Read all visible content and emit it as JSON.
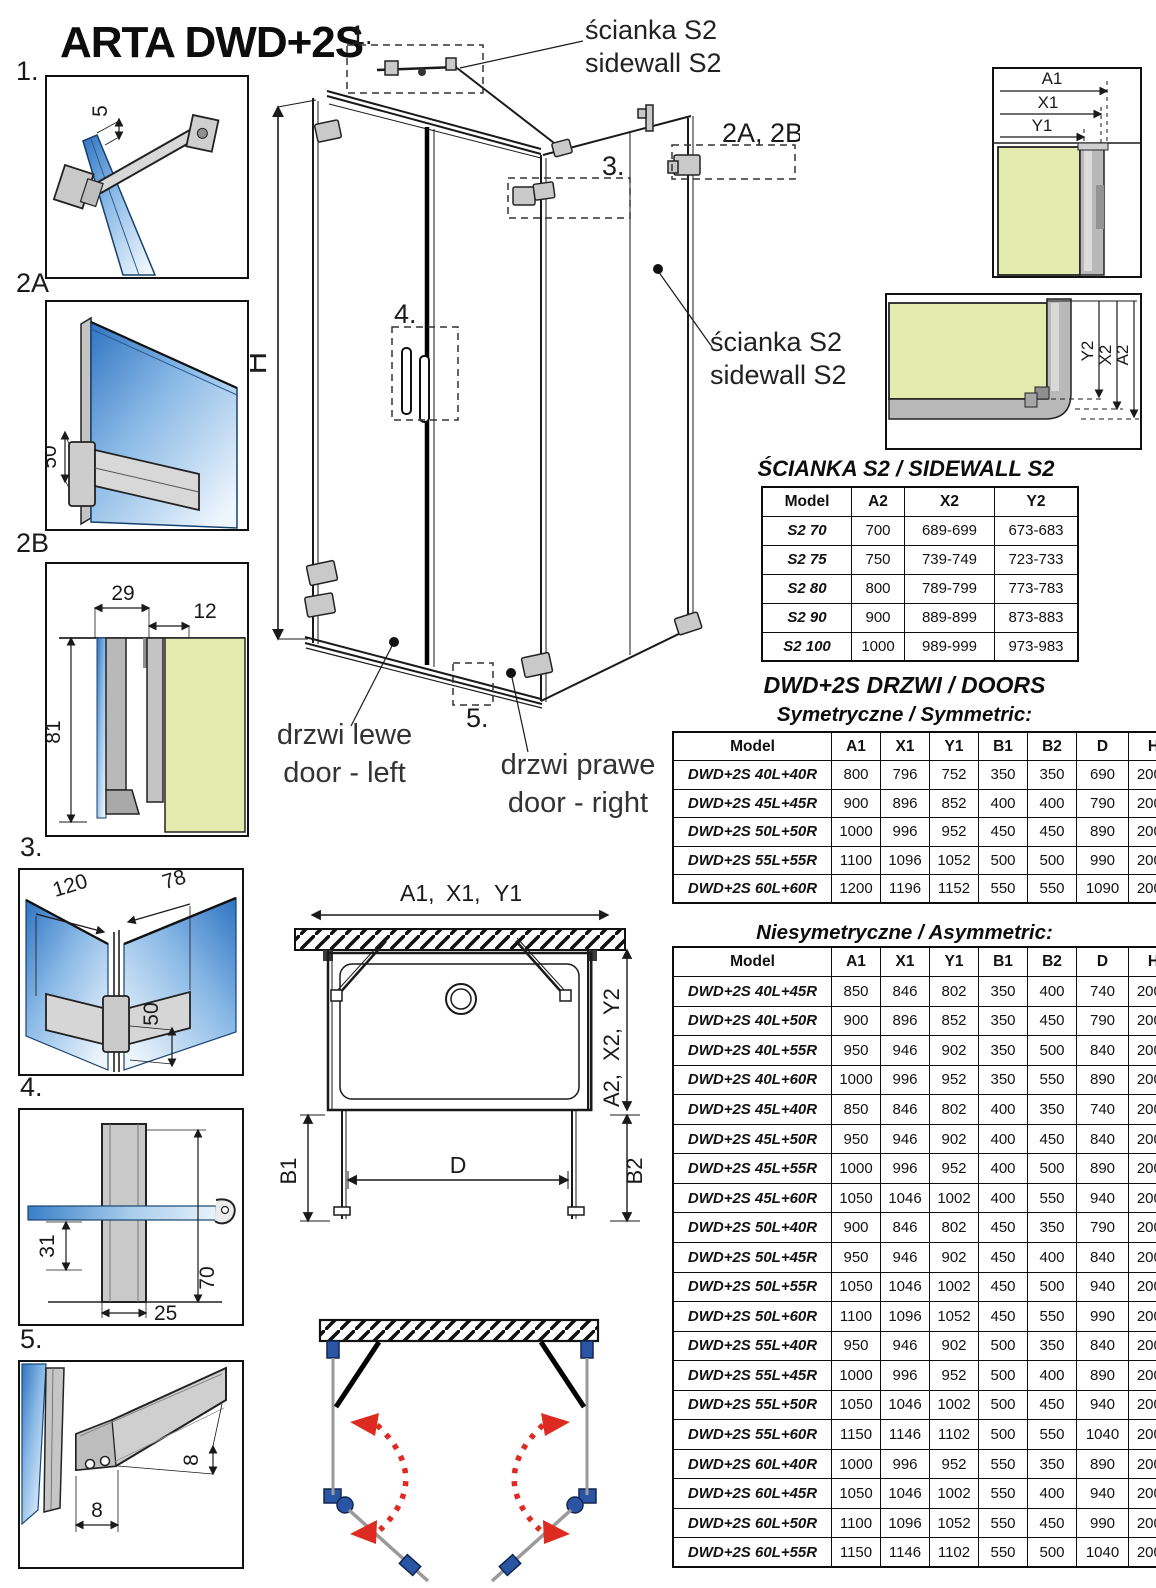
{
  "title": "ARTA DWD+2S",
  "colors": {
    "dim_red": "#cf2726",
    "dim_gray": "#8a8a8a",
    "dim_blue": "#2c4d92",
    "dim_purple": "#5d4a9c",
    "glass_blue": "#2f74c2",
    "glass_green": "#e3ebae",
    "arrow_red": "#dd2b22",
    "hardware_blue": "#2a55a4"
  },
  "details": {
    "d1": {
      "label": "1.",
      "dim_gap": "5"
    },
    "d2a": {
      "label": "2A",
      "dim_height": "50"
    },
    "d2b": {
      "label": "2B",
      "dim_a": "29",
      "dim_b": "12",
      "dim_c": "81"
    },
    "d3": {
      "label": "3.",
      "dim_a": "120",
      "dim_b": "78",
      "dim_c": "50"
    },
    "d4": {
      "label": "4.",
      "dim_a": "31",
      "dim_b": "25",
      "dim_c": "70"
    },
    "d5": {
      "label": "5.",
      "dim_a": "8",
      "dim_b": "8"
    }
  },
  "main": {
    "callout_1": "1.",
    "callout_2ab": "2A, 2B",
    "callout_3": "3.",
    "callout_4": "4.",
    "callout_5": "5.",
    "height_label": "H",
    "sidewall_top": {
      "pl": "ścianka S2",
      "en": "sidewall S2"
    },
    "sidewall_right": {
      "pl": "ścianka S2",
      "en": "sidewall S2"
    },
    "door_left": {
      "pl": "drzwi lewe",
      "en": "door - left"
    },
    "door_right": {
      "pl": "drzwi prawe",
      "en": "door - right"
    }
  },
  "corner_top": {
    "a1": "A1",
    "x1": "X1",
    "y1": "Y1"
  },
  "corner_bottom": {
    "a2": "A2",
    "x2": "X2",
    "y2": "Y2"
  },
  "plan": {
    "a1": "A1,",
    "x1": "X1,",
    "y1": "Y1",
    "a2": "A2,",
    "x2": "X2,",
    "y2": "Y2",
    "b1": "B1",
    "b2": "B2",
    "d": "D"
  },
  "sidewall_table": {
    "title": "ŚCIANKA S2 / SIDEWALL S2",
    "headers": [
      "Model",
      "A2",
      "X2",
      "Y2"
    ],
    "header_styles": [
      "",
      "",
      "red",
      "gray"
    ],
    "rows": [
      [
        "S2 70",
        "700",
        "689-699",
        "673-683"
      ],
      [
        "S2 75",
        "750",
        "739-749",
        "723-733"
      ],
      [
        "S2 80",
        "800",
        "789-799",
        "773-783"
      ],
      [
        "S2 90",
        "900",
        "889-899",
        "873-883"
      ],
      [
        "S2 100",
        "1000",
        "989-999",
        "973-983"
      ]
    ]
  },
  "doors": {
    "title": "DWD+2S DRZWI / DOORS",
    "symmetric": {
      "title": "Symetryczne / Symmetric:",
      "headers": [
        "Model",
        "A1",
        "X1",
        "Y1",
        "B1",
        "B2",
        "D",
        "H"
      ],
      "header_styles": [
        "",
        "",
        "red",
        "gray",
        "blue",
        "blue",
        "purple",
        ""
      ],
      "rows": [
        [
          "DWD+2S 40L+40R",
          "800",
          "796",
          "752",
          "350",
          "350",
          "690",
          "2000"
        ],
        [
          "DWD+2S 45L+45R",
          "900",
          "896",
          "852",
          "400",
          "400",
          "790",
          "2000"
        ],
        [
          "DWD+2S 50L+50R",
          "1000",
          "996",
          "952",
          "450",
          "450",
          "890",
          "2000"
        ],
        [
          "DWD+2S 55L+55R",
          "1100",
          "1096",
          "1052",
          "500",
          "500",
          "990",
          "2000"
        ],
        [
          "DWD+2S 60L+60R",
          "1200",
          "1196",
          "1152",
          "550",
          "550",
          "1090",
          "2000"
        ]
      ]
    },
    "asymmetric": {
      "title": "Niesymetryczne / Asymmetric:",
      "headers": [
        "Model",
        "A1",
        "X1",
        "Y1",
        "B1",
        "B2",
        "D",
        "H"
      ],
      "header_styles": [
        "",
        "",
        "red",
        "gray",
        "blue",
        "blue",
        "purple",
        ""
      ],
      "rows": [
        [
          "DWD+2S 40L+45R",
          "850",
          "846",
          "802",
          "350",
          "400",
          "740",
          "2000"
        ],
        [
          "DWD+2S 40L+50R",
          "900",
          "896",
          "852",
          "350",
          "450",
          "790",
          "2000"
        ],
        [
          "DWD+2S 40L+55R",
          "950",
          "946",
          "902",
          "350",
          "500",
          "840",
          "2000"
        ],
        [
          "DWD+2S 40L+60R",
          "1000",
          "996",
          "952",
          "350",
          "550",
          "890",
          "2000"
        ],
        [
          "DWD+2S 45L+40R",
          "850",
          "846",
          "802",
          "400",
          "350",
          "740",
          "2000"
        ],
        [
          "DWD+2S 45L+50R",
          "950",
          "946",
          "902",
          "400",
          "450",
          "840",
          "2000"
        ],
        [
          "DWD+2S 45L+55R",
          "1000",
          "996",
          "952",
          "400",
          "500",
          "890",
          "2000"
        ],
        [
          "DWD+2S 45L+60R",
          "1050",
          "1046",
          "1002",
          "400",
          "550",
          "940",
          "2000"
        ],
        [
          "DWD+2S 50L+40R",
          "900",
          "846",
          "802",
          "450",
          "350",
          "790",
          "2000"
        ],
        [
          "DWD+2S 50L+45R",
          "950",
          "946",
          "902",
          "450",
          "400",
          "840",
          "2000"
        ],
        [
          "DWD+2S 50L+55R",
          "1050",
          "1046",
          "1002",
          "450",
          "500",
          "940",
          "2000"
        ],
        [
          "DWD+2S 50L+60R",
          "1100",
          "1096",
          "1052",
          "450",
          "550",
          "990",
          "2000"
        ],
        [
          "DWD+2S 55L+40R",
          "950",
          "946",
          "902",
          "500",
          "350",
          "840",
          "2000"
        ],
        [
          "DWD+2S 55L+45R",
          "1000",
          "996",
          "952",
          "500",
          "400",
          "890",
          "2000"
        ],
        [
          "DWD+2S 55L+50R",
          "1050",
          "1046",
          "1002",
          "500",
          "450",
          "940",
          "2000"
        ],
        [
          "DWD+2S 55L+60R",
          "1150",
          "1146",
          "1102",
          "500",
          "550",
          "1040",
          "2000"
        ],
        [
          "DWD+2S 60L+40R",
          "1000",
          "996",
          "952",
          "550",
          "350",
          "890",
          "2000"
        ],
        [
          "DWD+2S 60L+45R",
          "1050",
          "1046",
          "1002",
          "550",
          "400",
          "940",
          "2000"
        ],
        [
          "DWD+2S 60L+50R",
          "1100",
          "1096",
          "1052",
          "550",
          "450",
          "990",
          "2000"
        ],
        [
          "DWD+2S 60L+55R",
          "1150",
          "1146",
          "1102",
          "550",
          "500",
          "1040",
          "2000"
        ]
      ]
    }
  }
}
